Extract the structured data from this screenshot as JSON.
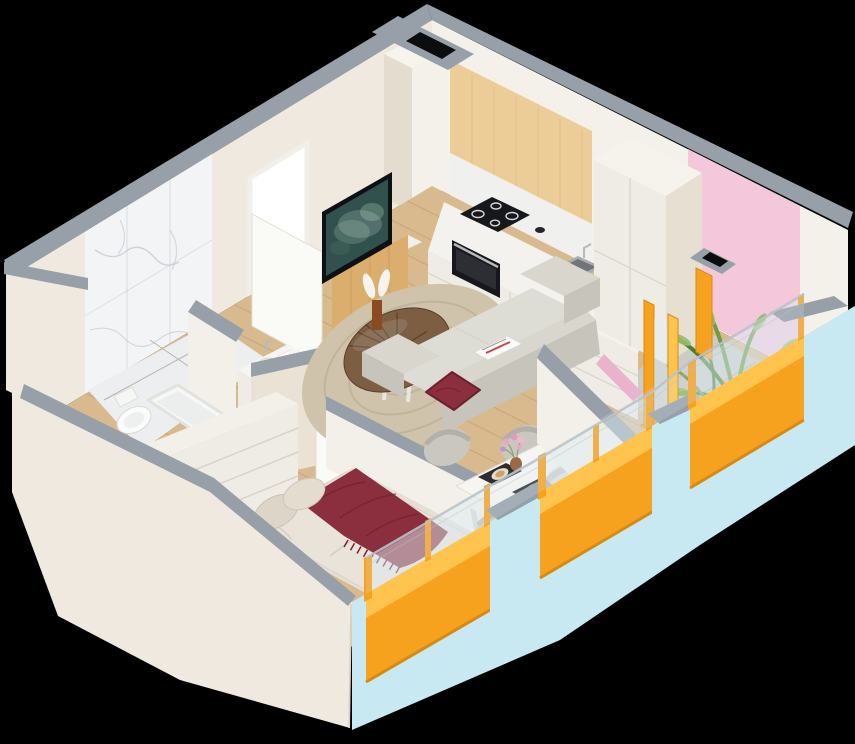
{
  "scene": {
    "subject": "isometric-cutaway-apartment-floorplan",
    "rooms": [
      {
        "id": "kitchen",
        "objects": [
          "upper-wood-cabinet",
          "countertop",
          "induction-cooktop",
          "oven",
          "sink",
          "tall-cabinet",
          "corner-column",
          "vent-shaft"
        ]
      },
      {
        "id": "living-room",
        "objects": [
          "tv",
          "tv-stand",
          "sofa",
          "maroon-cushion",
          "magazine",
          "round-coffee-table",
          "vase-with-feathers",
          "round-rug"
        ]
      },
      {
        "id": "dining-nook",
        "objects": [
          "dining-table",
          "placemats",
          "flower-vase",
          "shell-chairs"
        ]
      },
      {
        "id": "bedroom",
        "objects": [
          "double-bed",
          "maroon-throw",
          "pillows",
          "dresser",
          "open-door",
          "window"
        ]
      },
      {
        "id": "bathroom",
        "objects": [
          "marble-wall",
          "toilet",
          "bathtub",
          "vanity"
        ]
      },
      {
        "id": "balcony",
        "objects": [
          "palm-plant",
          "pink-accent-wall",
          "concrete-floor",
          "glass-balustrade",
          "orange-frames"
        ]
      },
      {
        "id": "entry",
        "objects": [
          "open-entry-door",
          "doorway"
        ]
      }
    ],
    "window_count": 3
  },
  "palette": {
    "bg": "#000000",
    "cap": "#97a0a8",
    "cap_dark": "#7f8890",
    "wall_cream": "#efe9df",
    "wall_cream_dark": "#e3dccf",
    "wall_white": "#f4f1ea",
    "face_a": "#eae3d5",
    "face_b": "#f3f0e9",
    "face_c": "#e6dfd2",
    "marble": "#f3f4f6",
    "marble_vein": "#c7ccd3",
    "wood_floor": "#d9ba8e",
    "wood_floor_line": "#c19e6f",
    "wood_panel": "#eccd97",
    "wood_panel_line": "#ddb677",
    "wood_cab": "#dcae6e",
    "wood_cab_line": "#c6975a",
    "cabinet": "#efece5",
    "cabinet_line": "#d9d4c9",
    "counter": "#f3f2ee",
    "appliance_black": "#17181b",
    "steel": "#b7babd",
    "cyan": "#c8e9f1",
    "orange": "#f6a21f",
    "orange_light": "#ffc44d",
    "orange_dark": "#d88a10",
    "pink": "#f4c8da",
    "pink_dark": "#eab3cb",
    "sofa": "#d9d6ce",
    "sofa_shade": "#c7c4bb",
    "maroon": "#8b2e3e",
    "maroon_dark": "#6e1f2d",
    "rug": "#cfc3ab",
    "rug_line": "#b9a88b",
    "table_brown": "#7d5e42",
    "table_brown_dark": "#56402e",
    "bedding": "#e9e3d9",
    "bedding_shade": "#d5ccbe",
    "plant": "#6f9c44",
    "plant_dark": "#4e7c30",
    "plant_light": "#96bf6b",
    "concrete": "#cbcbc7",
    "concrete_line": "#b6b6b2",
    "glass": "rgba(220,236,242,0.38)",
    "rail": "#b9c3ca",
    "door_white": "#fafaf7",
    "tile": "#eceef0",
    "tv_screen": "#31514e"
  }
}
